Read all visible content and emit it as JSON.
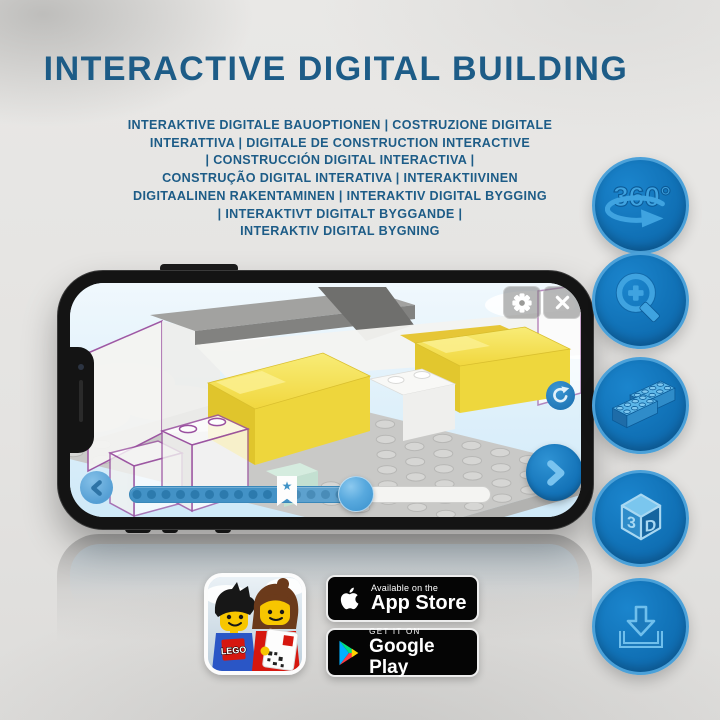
{
  "header": {
    "title": "INTERACTIVE DIGITAL BUILDING",
    "subtitle_lines": [
      "INTERAKTIVE DIGITALE BAUOPTIONEN | COSTRUZIONE DIGITALE",
      "INTERATTIVA | DIGITALE DE CONSTRUCTION INTERACTIVE",
      "| CONSTRUCCIÓN DIGITAL INTERACTIVA |",
      "CONSTRUÇÃO DIGITAL INTERATIVA | INTERAKTIIVINEN",
      "DIGITAALINEN RAKENTAMINEN | INTERAKTIV DIGITAL BYGGING",
      "| INTERAKTIVT DIGITALT BYGGANDE |",
      "INTERAKTIV DIGITAL BYGNING"
    ]
  },
  "feature_icons": {
    "names": [
      "360-rotation",
      "zoom-in",
      "building-bricks",
      "3d-view",
      "download"
    ],
    "rotation_label": "360°",
    "cube_front_label": "3",
    "cube_side_label": "D"
  },
  "phone_ui": {
    "bookmark_star": "★"
  },
  "badges": {
    "lego_app": {
      "logo_text": "LEGO"
    },
    "app_store": {
      "tagline": "Available on the",
      "store_name": "App Store"
    },
    "google_play": {
      "tagline": "GET IT ON",
      "store_name": "Google Play"
    }
  },
  "colors": {
    "title_blue": "#1d5c87",
    "icon_circle_blue": "#1173b9",
    "icon_glyph_blue": "#3fa3e0",
    "brick_yellow": "#f2d73c",
    "ghost_outline_purple": "#9a50a0"
  }
}
